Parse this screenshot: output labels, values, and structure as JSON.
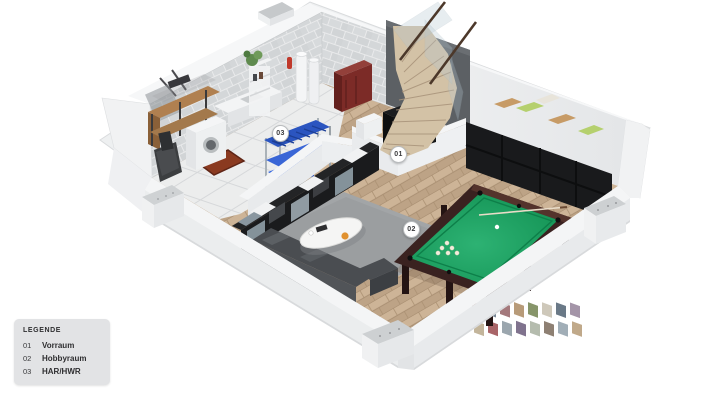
{
  "legend": {
    "title": "LEGENDE",
    "items": [
      {
        "number": "01",
        "label": "Vorraum"
      },
      {
        "number": "02",
        "label": "Hobbyraum"
      },
      {
        "number": "03",
        "label": "HAR/HWR"
      }
    ]
  },
  "plan": {
    "markers": [
      {
        "label": "01",
        "room": "Vorraum"
      },
      {
        "label": "02",
        "room": "Hobbyraum"
      },
      {
        "label": "03",
        "room": "HAR/HWR"
      }
    ]
  },
  "colors": {
    "background": "#ffffff",
    "legend_bg": "#e2e3e5",
    "brick_wall": "#d4d7d9",
    "dark_stair_wall": "#5c6064",
    "wood_floor": "#c6ad90",
    "tile_floor": "#eceded",
    "pool_felt": "#169c5c",
    "pool_frame": "#3a2220",
    "rug": "#a2a5a7",
    "sofa": "#4a4d51",
    "blue_rack_bin": "#2f62e0",
    "blue_rack_shelf": "#2b55c0",
    "red_boiler": "#7c2b27",
    "doormat": "#8a3a20",
    "shelf_black": "#191a1c"
  }
}
